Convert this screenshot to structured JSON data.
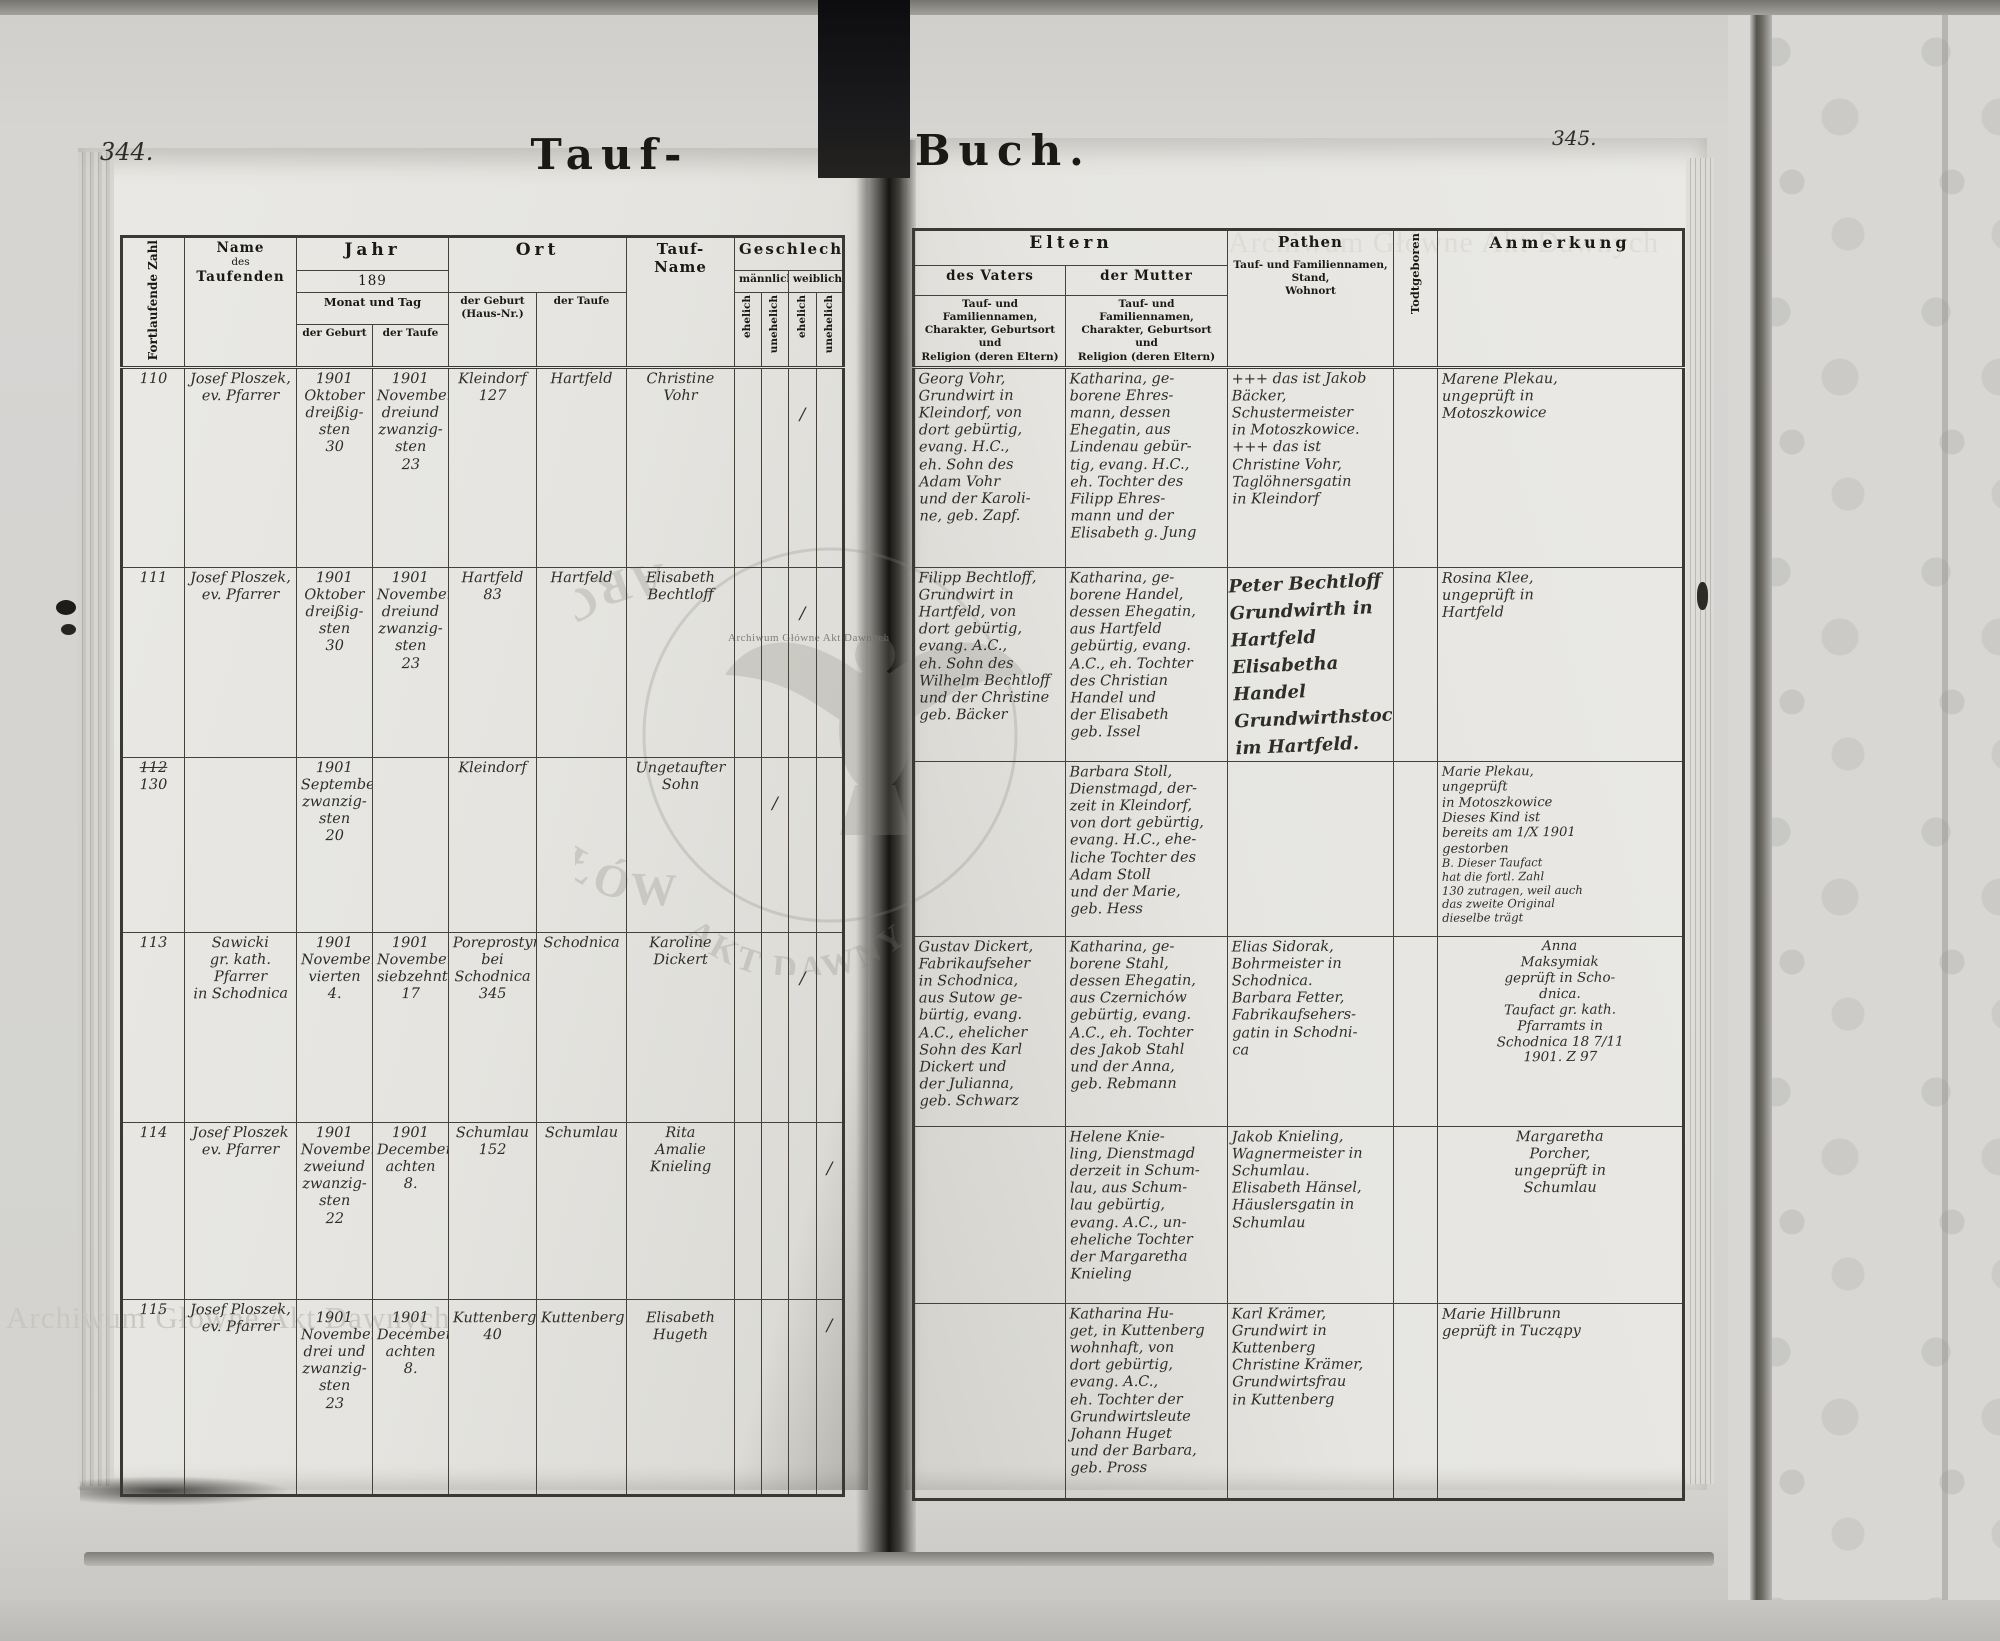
{
  "page": {
    "left_page_number": "344.",
    "right_page_number": "345.",
    "title_left": "Tauf-",
    "title_right": "Buch.",
    "watermark_top_right": "Archiwum Główne Akt Dawnych",
    "watermark_bottom_left": "Archiwum Główne Akt Dawnych",
    "stamp_arc_text": "ARCHIWUM · GŁÓWNE ·",
    "stamp_arc_text2": "AKT DAWNYCH",
    "stamp_caption": "Archiwum Główne Akt Dawnych"
  },
  "headers": {
    "fortlaufende_zahl": "Fortlaufende Zahl",
    "name_l1": "Name",
    "name_l2": "des",
    "name_l3": "Taufenden",
    "jahr": "Jahr",
    "jahr_year": "189",
    "monat_und_tag": "Monat und Tag",
    "der_geburt": "der Geburt",
    "der_taufe": "der Taufe",
    "ort": "Ort",
    "ort_geburt": "der Geburt\n(Haus-Nr.)",
    "ort_taufe": "der Taufe",
    "taufname": "Tauf-Name",
    "geschlecht": "Geschlecht",
    "maennlich": "männlich",
    "weiblich": "weiblich",
    "ehelich": "ehelich",
    "unehelich": "unehelich",
    "eltern": "Eltern",
    "des_vaters": "des Vaters",
    "der_mutter": "der Mutter",
    "eltern_sub": "Tauf- und Familiennamen,\nCharakter, Geburtsort und\nReligion (deren Eltern)",
    "pathen": "Pathen",
    "pathen_sub": "Tauf- und Familiennamen, Stand,\nWohnort",
    "todtgeboren": "Todtgeboren",
    "anmerkung": "Anmerkung"
  },
  "rows": [
    {
      "number": "110",
      "name": "Josef Ploszek,\nev. Pfarrer",
      "geburt_datum": "1901\nOktober\ndreißig-\nsten\n30",
      "taufe_datum": "1901\nNovember\ndreiund\nzwanzig-\nsten\n23",
      "ort_geburt": "Kleindorf\n127",
      "ort_taufe": "Hartfeld",
      "taufname": "Christine\nVohr",
      "geschlecht": {
        "me": "",
        "mu": "",
        "we": "/",
        "wu": ""
      },
      "vater": "Georg Vohr,\nGrundwirt in\nKleindorf, von\ndort gebürtig,\nevang. H.C.,\neh. Sohn des\nAdam Vohr\nund der Karoli-\nne, geb. Zapf.",
      "mutter": "Katharina, ge-\nborene Ehres-\nmann, dessen\nEhegatin, aus\nLindenau gebür-\ntig, evang. H.C.,\neh. Tochter des\nFilipp Ehres-\nmann und der\nElisabeth g. Jung",
      "pathen": "+++ das ist Jakob\nBäcker, Schustermeister\nin Motoszkowice.\n+++ das ist\nChristine Vohr,\nTaglöhnersgatin\nin Kleindorf",
      "todtgeboren": "",
      "anmerkung": "Marene Plekau,\nungeprüft in\nMotoszkowice",
      "anmerkung2": ""
    },
    {
      "number": "111",
      "name": "Josef Ploszek,\nev. Pfarrer",
      "geburt_datum": "1901\nOktober\ndreißig-\nsten\n30",
      "taufe_datum": "1901\nNovember\ndreiund\nzwanzig-\nsten\n23",
      "ort_geburt": "Hartfeld\n83",
      "ort_taufe": "Hartfeld",
      "taufname": "Elisabeth\nBechtloff",
      "geschlecht": {
        "me": "",
        "mu": "",
        "we": "/",
        "wu": ""
      },
      "vater": "Filipp Bechtloff,\nGrundwirt in\nHartfeld, von\ndort gebürtig,\nevang. A.C.,\neh. Sohn des\nWilhelm Bechtloff\nund der Christine\ngeb. Bäcker",
      "mutter": "Katharina, ge-\nborene Handel,\ndessen Ehegatin,\naus Hartfeld\ngebürtig, evang.\nA.C., eh. Tochter\ndes Christian\nHandel und\nder Elisabeth\ngeb. Issel",
      "pathen": "Peter Bechtloff\nGrundwirth in\nHartfeld\nElisabetha Handel\nGrundwirthstochter\nim Hartfeld.",
      "todtgeboren": "",
      "anmerkung": "Rosina Klee,\nungeprüft in\nHartfeld",
      "anmerkung2": ""
    },
    {
      "number_struck": "112",
      "number": "130",
      "name": "",
      "geburt_datum": "1901\nSeptember\nzwanzig-\nsten\n20",
      "taufe_datum": "",
      "ort_geburt": "Kleindorf",
      "ort_taufe": "",
      "taufname": "Ungetaufter\nSohn",
      "geschlecht": {
        "me": "",
        "mu": "/",
        "we": "",
        "wu": ""
      },
      "vater": "",
      "mutter": "Barbara Stoll,\nDienstmagd, der-\nzeit in Kleindorf,\nvon dort gebürtig,\nevang. H.C., ehe-\nliche Tochter des\nAdam Stoll\nund der Marie,\ngeb. Hess",
      "pathen": "",
      "todtgeboren": "",
      "anmerkung": "Marie Plekau,\nungeprüft\nin Motoszkowice\nDieses Kind ist\nbereits am 1/X 1901\ngestorben",
      "anmerkung2": "B. Dieser Taufact\nhat die fortl. Zahl\n130 zutragen, weil auch\ndas zweite Original\ndieselbe trägt"
    },
    {
      "number": "113",
      "name": "Sawicki\ngr. kath.\nPfarrer\nin Schodnica",
      "geburt_datum": "1901\nNovember\nvierten\n4.",
      "taufe_datum": "1901\nNovember\nsiebzehnten\n17",
      "ort_geburt": "Poreprostyna\nbei\nSchodnica\n345",
      "ort_taufe": "Schodnica",
      "taufname": "Karoline\nDickert",
      "geschlecht": {
        "me": "",
        "mu": "",
        "we": "/",
        "wu": ""
      },
      "vater": "Gustav Dickert,\nFabrikaufseher\nin Schodnica,\naus Sutow ge-\nbürtig, evang.\nA.C., ehelicher\nSohn des Karl\nDickert und\nder Julianna,\ngeb. Schwarz",
      "mutter": "Katharina, ge-\nborene Stahl,\ndessen Ehegatin,\naus Czernichów\ngebürtig, evang.\nA.C., eh. Tochter\ndes Jakob Stahl\nund der Anna,\ngeb. Rebmann",
      "pathen": "Elias Sidorak,\nBohrmeister in\nSchodnica.\nBarbara Fetter,\nFabrikaufsehers-\ngatin in Schodni-\nca",
      "todtgeboren": "",
      "anmerkung": "Anna\nMaksymiak\ngeprüft in Scho-\ndnica.\nTaufact gr. kath.\nPfarramts in\nSchodnica 18 7/11\n1901. Z 97",
      "anmerkung2": ""
    },
    {
      "number": "114",
      "name": "Josef Ploszek\nev. Pfarrer",
      "geburt_datum": "1901\nNovember\nzweiund\nzwanzig-\nsten\n22",
      "taufe_datum": "1901\nDecember\nachten\n8.",
      "ort_geburt": "Schumlau\n152",
      "ort_taufe": "Schumlau",
      "taufname": "Rita\nAmalie\nKnieling",
      "geschlecht": {
        "me": "",
        "mu": "",
        "we": "",
        "wu": "/"
      },
      "vater": "",
      "mutter": "Helene Knie-\nling, Dienstmagd\nderzeit in Schum-\nlau, aus Schum-\nlau gebürtig,\nevang. A.C., un-\neheliche Tochter\nder Margaretha\nKnieling",
      "pathen": "Jakob Knieling,\nWagnermeister in\nSchumlau.\nElisabeth Hänsel,\nHäuslersgatin in\nSchumlau",
      "todtgeboren": "",
      "anmerkung": "Margaretha\nPorcher,\nungeprüft in\nSchumlau",
      "anmerkung2": ""
    },
    {
      "number": "115",
      "name": "Josef Ploszek,\nev. Pfarrer",
      "geburt_datum": "1901\nNovember\ndrei und\nzwanzig-\nsten\n23",
      "taufe_datum": "1901\nDecember\nachten\n8.",
      "ort_geburt": "Kuttenberg\n40",
      "ort_taufe": "Kuttenberg",
      "taufname": "Elisabeth\nHugeth",
      "geschlecht": {
        "me": "",
        "mu": "",
        "we": "",
        "wu": "/"
      },
      "vater": "",
      "mutter": "Katharina Hu-\nget, in Kuttenberg\nwohnhaft, von\ndort gebürtig,\nevang. A.C.,\neh. Tochter der\nGrundwirtsleute\nJohann Huget\nund der Barbara,\ngeb. Pross",
      "pathen": "Karl Krämer,\nGrundwirt in\nKuttenberg\nChristine Krämer,\nGrundwirtsfrau\nin Kuttenberg",
      "todtgeboren": "",
      "anmerkung": "Marie Hillbrunn\ngeprüft in Tucząpy",
      "anmerkung2": ""
    }
  ]
}
